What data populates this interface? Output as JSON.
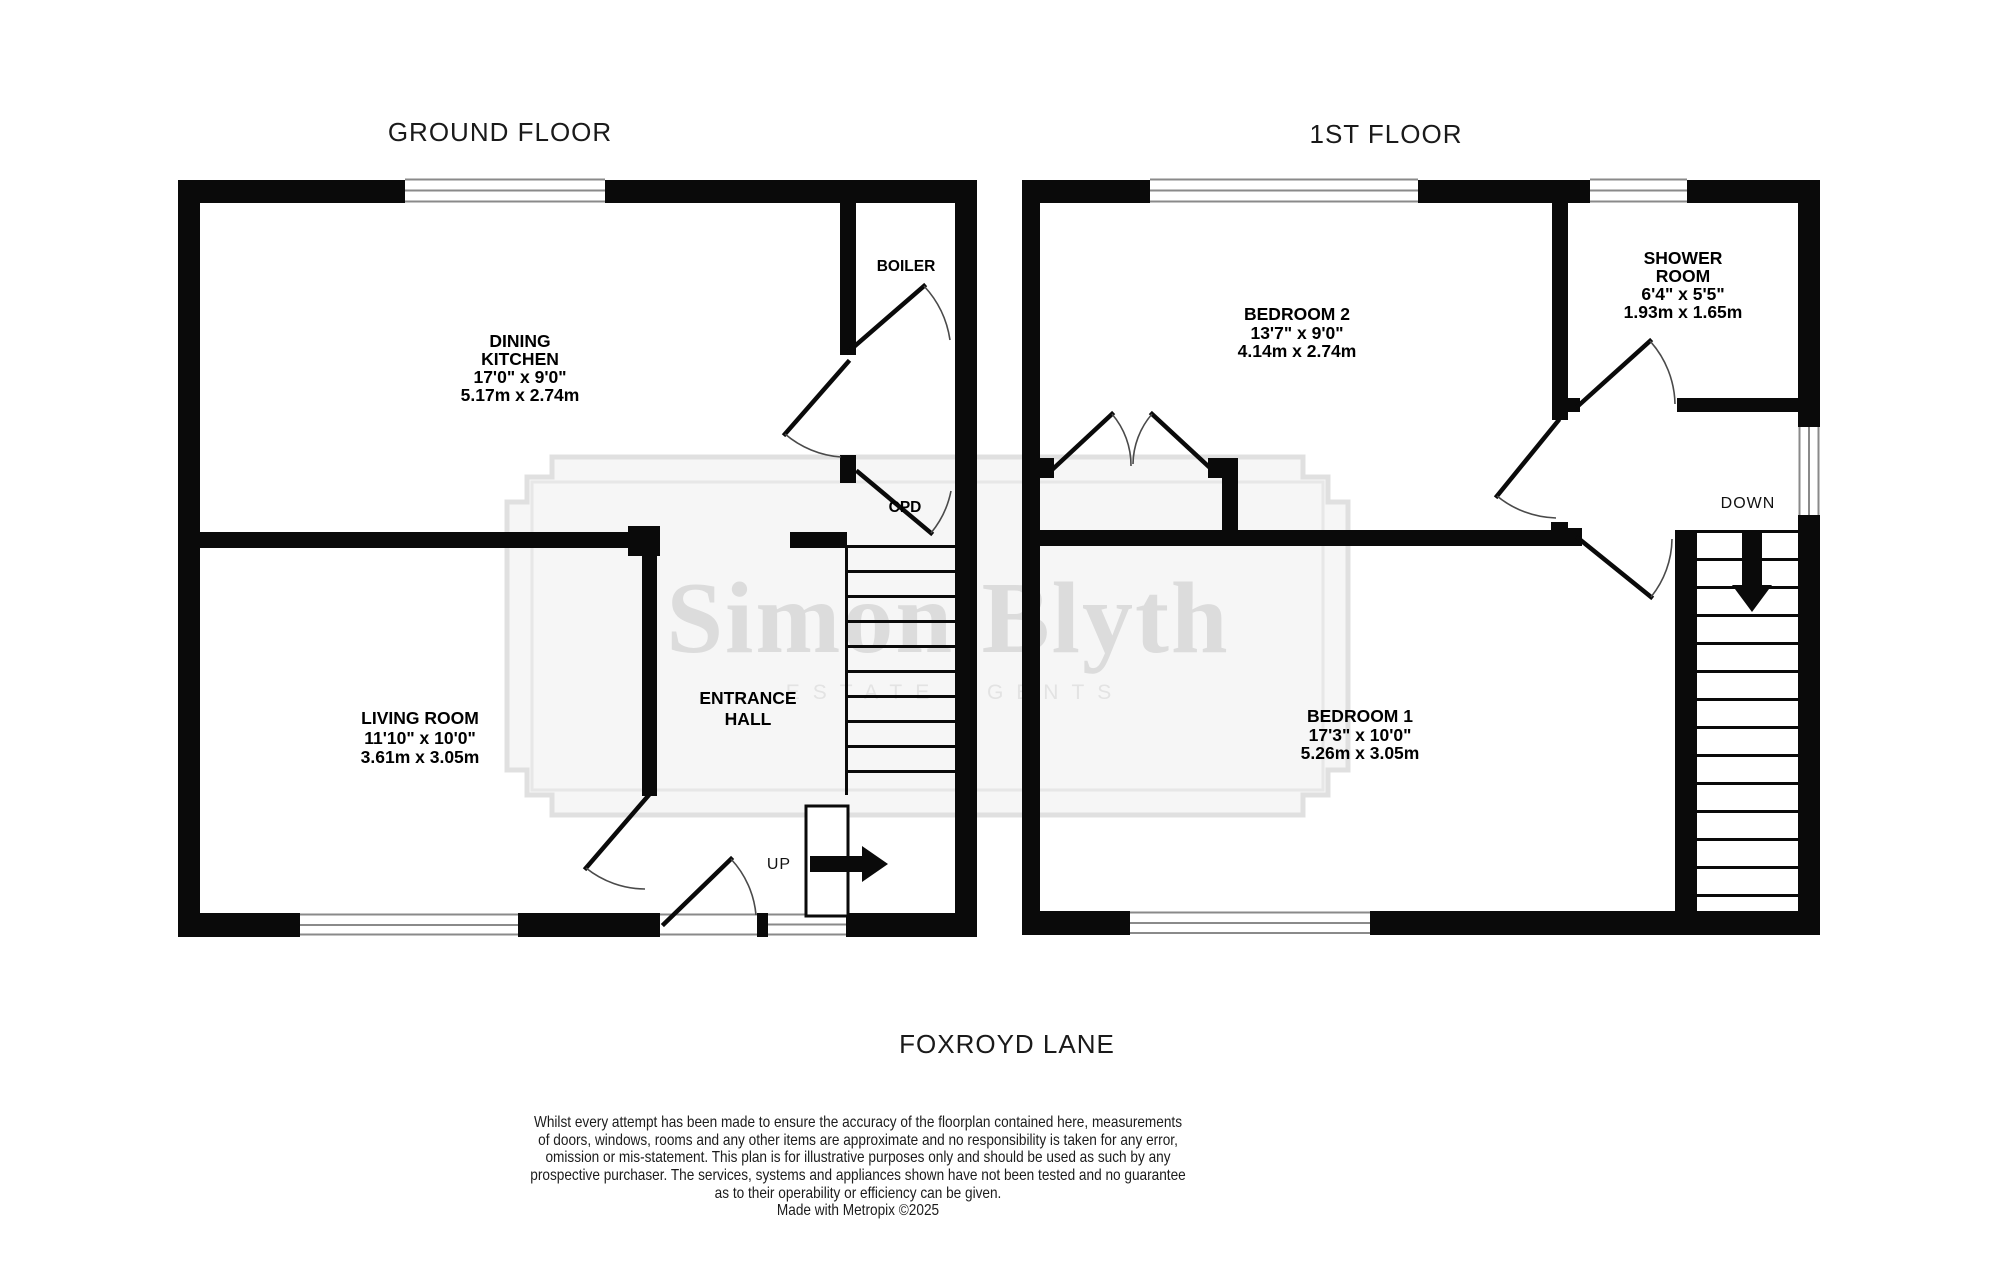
{
  "page": {
    "background": "#ffffff"
  },
  "colors": {
    "wall": "#0a0a0a",
    "door_arc": "#4a4a4a",
    "window_line": "#8a8a8a",
    "label_text": "#000000",
    "title_text": "#1a1a1a",
    "watermark_text": "#dcdcdc",
    "watermark_border": "#e0e0e0",
    "watermark_fill": "#f6f6f6"
  },
  "ground_floor": {
    "title": "GROUND FLOOR",
    "dining_kitchen": [
      "DINING",
      "KITCHEN",
      "17'0\"  x 9'0\"",
      "5.17m  x 2.74m"
    ],
    "living_room": [
      "LIVING ROOM",
      "11'10\"  x 10'0\"",
      "3.61m  x 3.05m"
    ],
    "entrance_hall": [
      "ENTRANCE",
      "HALL"
    ],
    "boiler": "BOILER",
    "cupboard": "CPD",
    "stair_direction": "UP"
  },
  "first_floor": {
    "title": "1ST FLOOR",
    "bedroom_2": [
      "BEDROOM 2",
      "13'7\"  x 9'0\"",
      "4.14m  x 2.74m"
    ],
    "shower_room": [
      "SHOWER",
      "ROOM",
      "6'4\"  x 5'5\"",
      "1.93m  x 1.65m"
    ],
    "bedroom_1": [
      "BEDROOM 1",
      "17'3\"  x 10'0\"",
      "5.26m  x 3.05m"
    ],
    "stair_direction": "DOWN"
  },
  "watermark": {
    "brand": "Simon Blyth",
    "tagline": "ESTATE AGENTS"
  },
  "address": "FOXROYD LANE",
  "disclaimer": [
    "Whilst every attempt has been made to ensure the accuracy of the floorplan contained here, measurements",
    "of doors, windows, rooms and any other items are approximate and no responsibility is taken for any error,",
    "omission or mis-statement. This plan is for illustrative purposes only and should be used as such by any",
    "prospective purchaser. The services, systems and appliances shown have not been tested and no guarantee",
    "as to their operability or efficiency can be given.",
    "Made with Metropix ©2025"
  ]
}
